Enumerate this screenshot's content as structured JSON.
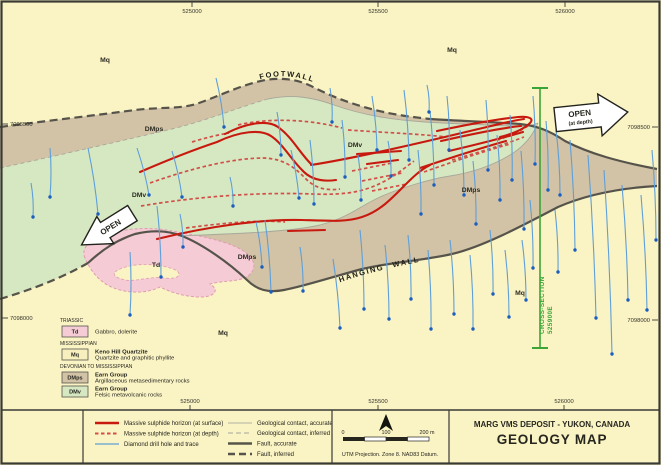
{
  "colors": {
    "background": "#FAF3C4",
    "dmps": "#D2C2A6",
    "dmv": "#D6E8C2",
    "td": "#F5CBD6",
    "td_outline": "#DE9DB0",
    "mq_box": "#F7F0BE",
    "sulphide": "#C8190F",
    "sulphide_depth": "#D05048",
    "drill": "#5E9FD8",
    "drill_dot": "#1B5EBE",
    "fault": "#56544A",
    "contact": "#A8A89A",
    "section": "#3BA437",
    "frame": "#3A3A35"
  },
  "map": {
    "fault_labels": {
      "footwall": "FOOTWALL",
      "hangingwall": "HANGING WALL"
    },
    "fault_label_paths": {
      "footwall": "M258,80 C285,72 308,78 328,89 C350,101 372,108 398,114",
      "hangingwall": "M338,283 C380,268 430,259 492,250"
    },
    "unit_labels": [
      {
        "text": "Mq",
        "x": 105,
        "y": 62
      },
      {
        "text": "Mq",
        "x": 452,
        "y": 52
      },
      {
        "text": "Mq",
        "x": 520,
        "y": 295
      },
      {
        "text": "Mq",
        "x": 223,
        "y": 335
      },
      {
        "text": "DMps",
        "x": 154,
        "y": 131
      },
      {
        "text": "DMps",
        "x": 471,
        "y": 192
      },
      {
        "text": "DMps",
        "x": 247,
        "y": 259
      },
      {
        "text": "DMv",
        "x": 139,
        "y": 197
      },
      {
        "text": "DMv",
        "x": 355,
        "y": 147
      },
      {
        "text": "Td",
        "x": 156,
        "y": 267
      }
    ],
    "coordinates": {
      "top": [
        {
          "label": "525000",
          "x": 192
        },
        {
          "label": "525500",
          "x": 378
        },
        {
          "label": "526000",
          "x": 565
        }
      ],
      "bottom": [
        {
          "label": "525000",
          "x": 190
        },
        {
          "label": "525500",
          "x": 378
        },
        {
          "label": "526000",
          "x": 564
        }
      ],
      "left": [
        {
          "label": "7098500",
          "y": 124
        },
        {
          "label": "7098000",
          "y": 318
        }
      ],
      "right": [
        {
          "label": "7098500",
          "y": 127
        },
        {
          "label": "7098000",
          "y": 320
        }
      ]
    },
    "open_left": {
      "label": "OPEN"
    },
    "open_right": {
      "label": "OPEN",
      "sub": "(at depth)"
    },
    "cross_section": {
      "line1": "CROSS-SECTION",
      "line2": "525900E"
    }
  },
  "geology": {
    "regions": {
      "dmps": "M0,127 C45,121 90,116 135,110 C160,107 180,109 196,104 C215,98 240,85 265,80 C285,77 300,80 315,88 C335,98 355,105 375,110 C395,115 412,117 430,119 C460,121 495,122 520,124 C538,126 550,131 565,141 C590,154 620,162 657,169 L657,186 C620,188 588,194 558,207 C520,227 482,247 452,254 C420,261 392,262 362,269 C332,277 305,286 284,290 C268,293 257,290 247,280 C228,262 202,244 182,236 C167,230 152,230 135,234 C117,240 103,249 88,263 C60,279 30,290 0,299 Z",
      "dmv": "M0,168 C60,155 125,140 172,129 C212,119 242,106 268,99 C292,94 312,97 334,105 C365,116 395,120 425,122 C455,124 490,125 510,126 C522,127 532,126 538,123 C533,135 525,146 510,155 C495,164 475,172 450,176 C430,179 400,188 380,197 C360,206 350,217 320,225 C290,232 230,234 178,236 C165,231 152,230 135,234 C117,240 103,249 88,263 C60,279 30,290 0,299 Z",
      "td": "M85,258 C80,247 92,238 110,233 C130,228 152,227 172,231 C195,235 225,240 242,250 C255,258 258,268 248,276 C240,282 225,280 210,284 C220,290 215,297 200,297 C185,297 170,292 160,287 C150,292 135,294 120,290 C100,285 90,270 85,258 Z",
      "td_window": "M115,272 C125,264 150,262 170,268 C185,272 180,280 165,278 C150,276 135,282 125,280 C118,278 112,276 115,272 Z"
    },
    "contacts": {
      "upper_inferred": "M0,168 C60,155 125,140 172,129 C212,119 242,106 268,99",
      "upper_accurate": "M268,99 C292,94 312,97 334,105 C365,116 395,120 425,122 C455,124 490,125 510,126 C522,127 532,126 538,123",
      "lower_accurate": "M178,236 C230,234 290,232 320,225 C350,217 360,206 380,197 C400,188 430,179 450,176 C475,172 495,164 510,155 C525,146 533,135 538,123"
    },
    "faults": {
      "footwall_inferred": "M0,127 C45,121 90,116 135,110 C160,107 180,109 196,104 C215,98 240,85 265,80 C285,77 300,80 315,88 C335,98 355,105 375,110 C395,115 412,117 430,119",
      "footwall_accurate": "M430,119 C460,121 495,122 520,124 C538,126 550,131 565,141 C590,154 620,162 657,169",
      "hangingwall_accurate": "M88,263 C103,249 117,240 135,234 C152,230 167,230 182,236 C202,244 228,262 247,280 C257,290 268,293 284,290 C305,286 332,277 362,269 C392,262 420,261 452,254 C482,247 520,227 558,207 C588,194 620,188 657,186",
      "hangingwall_inferred": "M0,299 C30,290 60,279 88,263"
    },
    "sulphide_surface": [
      "M225,134 C248,122 268,120 278,127 C292,137 299,152 311,164",
      "M140,172 C170,159 196,149 217,142 C240,131 261,129 271,136 C283,144 290,158 302,170 C310,179 322,182 336,180",
      "M311,165 C350,159 420,143 470,131 C492,126 510,121 524,119",
      "M157,239 C210,226 262,219 302,220 C332,221 347,222 362,217 C380,211 391,199 403,187 C412,178 420,170 430,165",
      "M288,231 L325,230",
      "M357,154 L401,151",
      "M367,164 L398,160",
      "M437,131 C470,124 500,119 518,117 C530,116 534,119 530,123 C523,130 512,134 500,137",
      "M441,141 C472,134 500,128 521,126",
      "M449,151 C479,144 506,137 523,132",
      "M420,168 C450,158 481,148 506,141"
    ],
    "sulphide_depth": [
      "M238,125 C272,117 312,120 342,128",
      "M348,130 C392,133 420,134 446,137",
      "M192,142 C205,138 217,135 229,133",
      "M150,183 C195,167 235,158 264,158 C286,159 296,169 306,179 C315,188 326,191 340,189",
      "M141,206 C200,196 262,192 312,194 C340,195 356,193 372,187 C390,180 402,170 414,161",
      "M186,228 C230,222 262,220 285,222",
      "M424,172 C452,162 482,152 510,144",
      "M452,160 C480,152 506,144 524,137",
      "M352,171 L392,163",
      "M362,181 L402,173",
      "M372,191 L407,184",
      "M497,140 C508,137 520,131 528,126"
    ],
    "drill_holes": [
      [
        50,
        148,
        50,
        197
      ],
      [
        31,
        183,
        33,
        217
      ],
      [
        88,
        148,
        98,
        214
      ],
      [
        137,
        148,
        149,
        195
      ],
      [
        172,
        151,
        182,
        197
      ],
      [
        216,
        78,
        224,
        127
      ],
      [
        230,
        177,
        233,
        206
      ],
      [
        130,
        252,
        130,
        315
      ],
      [
        157,
        206,
        161,
        277
      ],
      [
        180,
        214,
        183,
        247
      ],
      [
        256,
        222,
        262,
        267
      ],
      [
        291,
        150,
        299,
        198
      ],
      [
        277,
        112,
        281,
        155
      ],
      [
        310,
        140,
        314,
        204
      ],
      [
        330,
        88,
        332,
        122
      ],
      [
        342,
        120,
        345,
        177
      ],
      [
        358,
        155,
        361,
        200
      ],
      [
        372,
        96,
        377,
        150
      ],
      [
        388,
        141,
        391,
        176
      ],
      [
        404,
        90,
        409,
        160
      ],
      [
        418,
        150,
        421,
        214
      ],
      [
        430,
        111,
        434,
        185
      ],
      [
        447,
        96,
        449,
        150
      ],
      [
        460,
        130,
        464,
        195
      ],
      [
        473,
        161,
        476,
        224
      ],
      [
        486,
        100,
        488,
        170
      ],
      [
        497,
        135,
        500,
        200
      ],
      [
        510,
        115,
        512,
        180
      ],
      [
        521,
        151,
        524,
        229
      ],
      [
        533,
        96,
        535,
        164
      ],
      [
        546,
        121,
        548,
        190
      ],
      [
        427,
        85,
        429,
        112
      ],
      [
        265,
        220,
        271,
        292
      ],
      [
        300,
        247,
        303,
        291
      ],
      [
        333,
        259,
        340,
        328
      ],
      [
        360,
        230,
        364,
        309
      ],
      [
        385,
        245,
        389,
        319
      ],
      [
        408,
        235,
        411,
        299
      ],
      [
        428,
        250,
        431,
        329
      ],
      [
        450,
        240,
        454,
        314
      ],
      [
        470,
        255,
        473,
        329
      ],
      [
        490,
        230,
        493,
        294
      ],
      [
        505,
        250,
        509,
        317
      ],
      [
        522,
        240,
        526,
        300
      ],
      [
        530,
        200,
        533,
        268
      ],
      [
        555,
        210,
        558,
        272
      ],
      [
        570,
        140,
        575,
        250
      ],
      [
        588,
        155,
        596,
        318
      ],
      [
        604,
        170,
        612,
        354
      ],
      [
        622,
        185,
        628,
        300
      ],
      [
        641,
        195,
        647,
        310
      ],
      [
        652,
        150,
        656,
        240
      ],
      [
        556,
        130,
        560,
        195
      ]
    ]
  },
  "unit_legend": {
    "groups": [
      {
        "era": "TRIASSIC",
        "y": 322,
        "units": [
          {
            "code": "Td",
            "color_key": "td",
            "y": 326,
            "lines": [
              "Gabbro, dolerite"
            ],
            "bold_first": false
          }
        ]
      },
      {
        "era": "MISSISSIPPIAN",
        "y": 345,
        "units": [
          {
            "code": "Mq",
            "color_key": "mq_box",
            "y": 349,
            "lines": [
              "Keno Hill Quartzite",
              "Quartzite and graphitic phyllite"
            ],
            "bold_first": true
          }
        ]
      },
      {
        "era": "DEVONIAN TO MISSISSIPPIAN",
        "y": 368,
        "units": [
          {
            "code": "DMps",
            "color_key": "dmps",
            "y": 372,
            "lines": [
              "Earn Group",
              "Argillaceous metasedimentary rocks"
            ],
            "bold_first": true
          },
          {
            "code": "DMv",
            "color_key": "dmv",
            "y": 386,
            "lines": [
              "Earn Group",
              "Felsic metavolcanic rocks"
            ],
            "bold_first": true
          }
        ]
      }
    ]
  },
  "line_legend": {
    "col1": [
      {
        "label": "Massive sulphide horizon (at surface)",
        "style": "red-solid",
        "y": 423
      },
      {
        "label": "Massive sulphide horizon (at depth)",
        "style": "red-dashed",
        "y": 433.5
      },
      {
        "label": "Diamond drill hole and trace",
        "style": "blue",
        "y": 444
      }
    ],
    "col2": [
      {
        "label": "Geological contact, accurate",
        "style": "gray-thin",
        "y": 423
      },
      {
        "label": "Geological contact, inferred",
        "style": "gray-dashed",
        "y": 433
      },
      {
        "label": "Fault, accurate",
        "style": "dark-thick",
        "y": 443.5
      },
      {
        "label": "Fault, inferred",
        "style": "dark-dashed",
        "y": 454
      }
    ]
  },
  "scale_panel": {
    "ticks": [
      {
        "label": "0",
        "x": 343
      },
      {
        "label": "100",
        "x": 386
      },
      {
        "label": "200 m",
        "x": 427
      }
    ],
    "note": "UTM Projection. Zone 8. NAD83 Datum."
  },
  "title_block": {
    "line1": "MARG VMS DEPOSIT - YUKON, CANADA",
    "line2": "GEOLOGY MAP"
  }
}
